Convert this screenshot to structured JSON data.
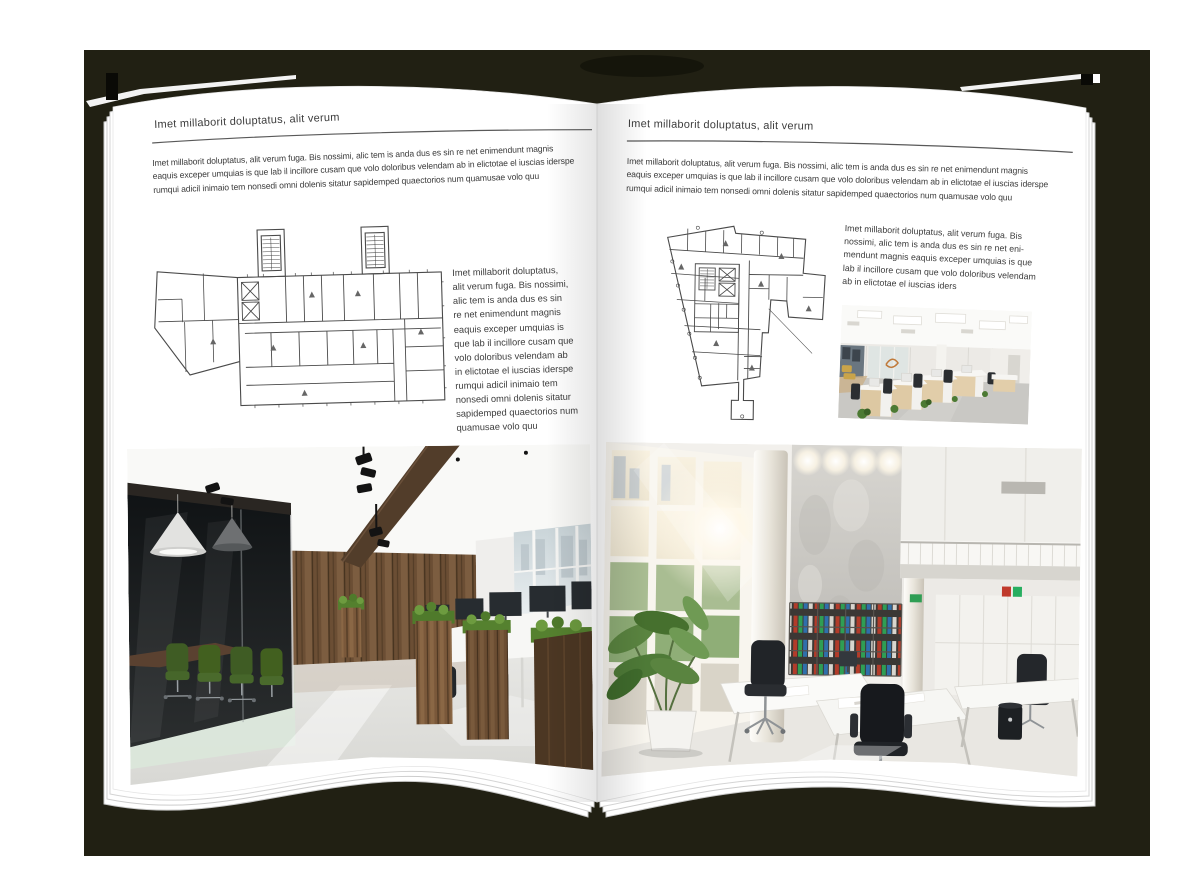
{
  "canvas": {
    "background": "#ffffff",
    "backdrop_color": "#212013",
    "page_color": "#ffffff",
    "text_color": "#3c3c3c",
    "rule_color": "#595959",
    "plan_line_color": "#4a4a4a"
  },
  "left_page": {
    "header": "Imet millaborit doluptatus, alit verum",
    "intro_lines": [
      "Imet millaborit doluptatus, alit verum fuga. Bis nossimi, alic tem is anda dus es sin re net enimendunt magnis",
      "eaquis exceper umquias is que lab il incillore cusam que volo doloribus velendam ab in elictotae el iuscias iderspe",
      "rumqui adicil inimaio tem nonsedi omni dolenis sitatur sapidemped quaectorios num quamusae volo quu"
    ],
    "floorplan": {
      "label": "rectangular office building floor plan with two stair towers"
    },
    "side_text_lines": [
      "Imet millaborit doluptatus,",
      "alit verum fuga. Bis nossimi,",
      "alic tem is anda dus es sin",
      "re net enimendunt magnis",
      "eaquis exceper umquias is",
      "que lab il incillore cusam que",
      "volo doloribus velendam ab",
      "in elictotae el iuscias iderspe",
      "rumqui adicil inimaio tem",
      "nonsedi omni dolenis sitatur",
      "sapidemped quaectorios num",
      "quamusae volo quu"
    ],
    "photo": {
      "label": "dark loft office with glass meeting room, green chairs, wood plank wall and workstations"
    }
  },
  "right_page": {
    "header": "Imet millaborit doluptatus, alit verum",
    "intro_lines": [
      "Imet millaborit doluptatus, alit verum fuga. Bis nossimi, alic tem is anda dus es sin re net enimendunt magnis",
      "eaquis exceper umquias is que lab il incillore cusam que volo doloribus velendam ab in elictotae el iuscias iderspe",
      "rumqui adicil inimaio tem nonsedi omni dolenis sitatur sapidemped quaectorios num quamusae volo quu"
    ],
    "floorplan": {
      "label": "irregular office building floor plan with central core"
    },
    "text_block_lines": [
      "Imet millaborit doluptatus, alit verum fuga. Bis",
      "nossimi, alic tem is anda dus es sin re net eni-",
      "mendunt magnis eaquis exceper umquias is que",
      "lab il incillore cusam que volo doloribus velendam",
      "ab in elictotae el iuscias iders"
    ],
    "photo_small": {
      "label": "bright open plan office with wooden desk rows and black chairs"
    },
    "photo_large": {
      "label": "double height white office atrium with window wall, binder shelves and white desks"
    }
  }
}
